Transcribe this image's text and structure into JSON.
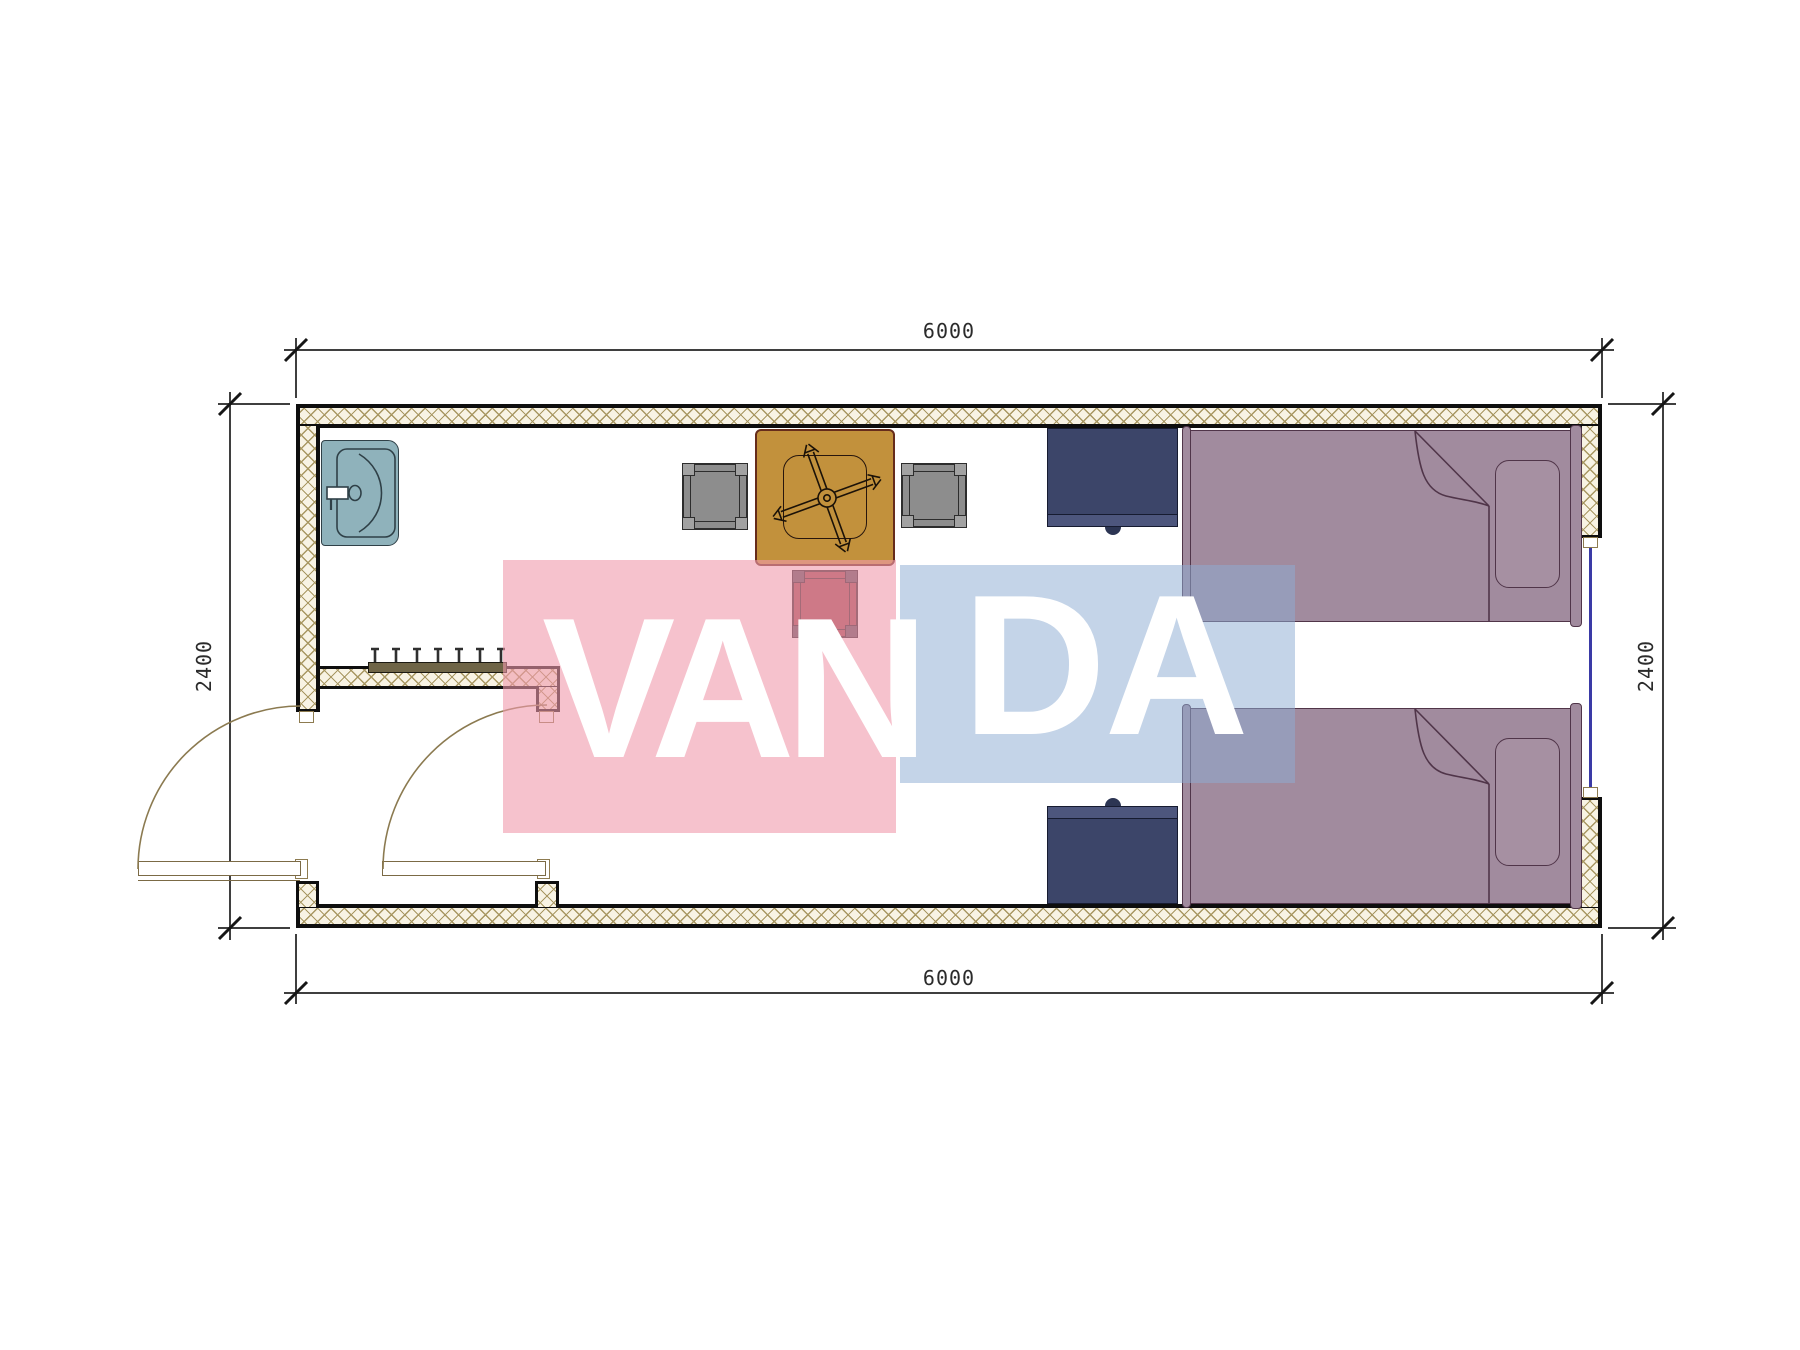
{
  "drawing": {
    "kind": "floor-plan",
    "room": "container unit with vestibule, two single beds, two nightstands, dining table with three chairs, wash sink, coat hook rail, two outward-swinging doors and one window"
  },
  "dimension_labels": {
    "top": "6000",
    "bottom": "6000",
    "left": "2400",
    "right": "2400"
  },
  "watermark": {
    "word": "VANDA",
    "left_text": "VAN",
    "right_text": "DA",
    "pink_color": "#f099ac",
    "blue_color": "#8dadd3"
  },
  "colors": {
    "wall_hatch_line": "#a89762",
    "wall_hatch_bg": "#f8f3e4",
    "wall_edge": "#0e0e0e",
    "sink": "#8fb2bb",
    "table": "#c2913c",
    "table_border": "#662c1b",
    "chair_gray": "#8d8d8d",
    "chair_red": "#9c4a50",
    "nightstand": "#3c4569",
    "bed": "#a18b9e",
    "window_line": "#3a3aa6",
    "door_arc": "#8b7a50"
  },
  "icons": [
    "sink-icon",
    "table-fan-icon",
    "chair-icon",
    "bed-icon",
    "pillow-icon",
    "nightstand-icon",
    "coat-hooks-icon",
    "door-leaf-icon",
    "door-swing-arc-icon",
    "window-icon"
  ]
}
